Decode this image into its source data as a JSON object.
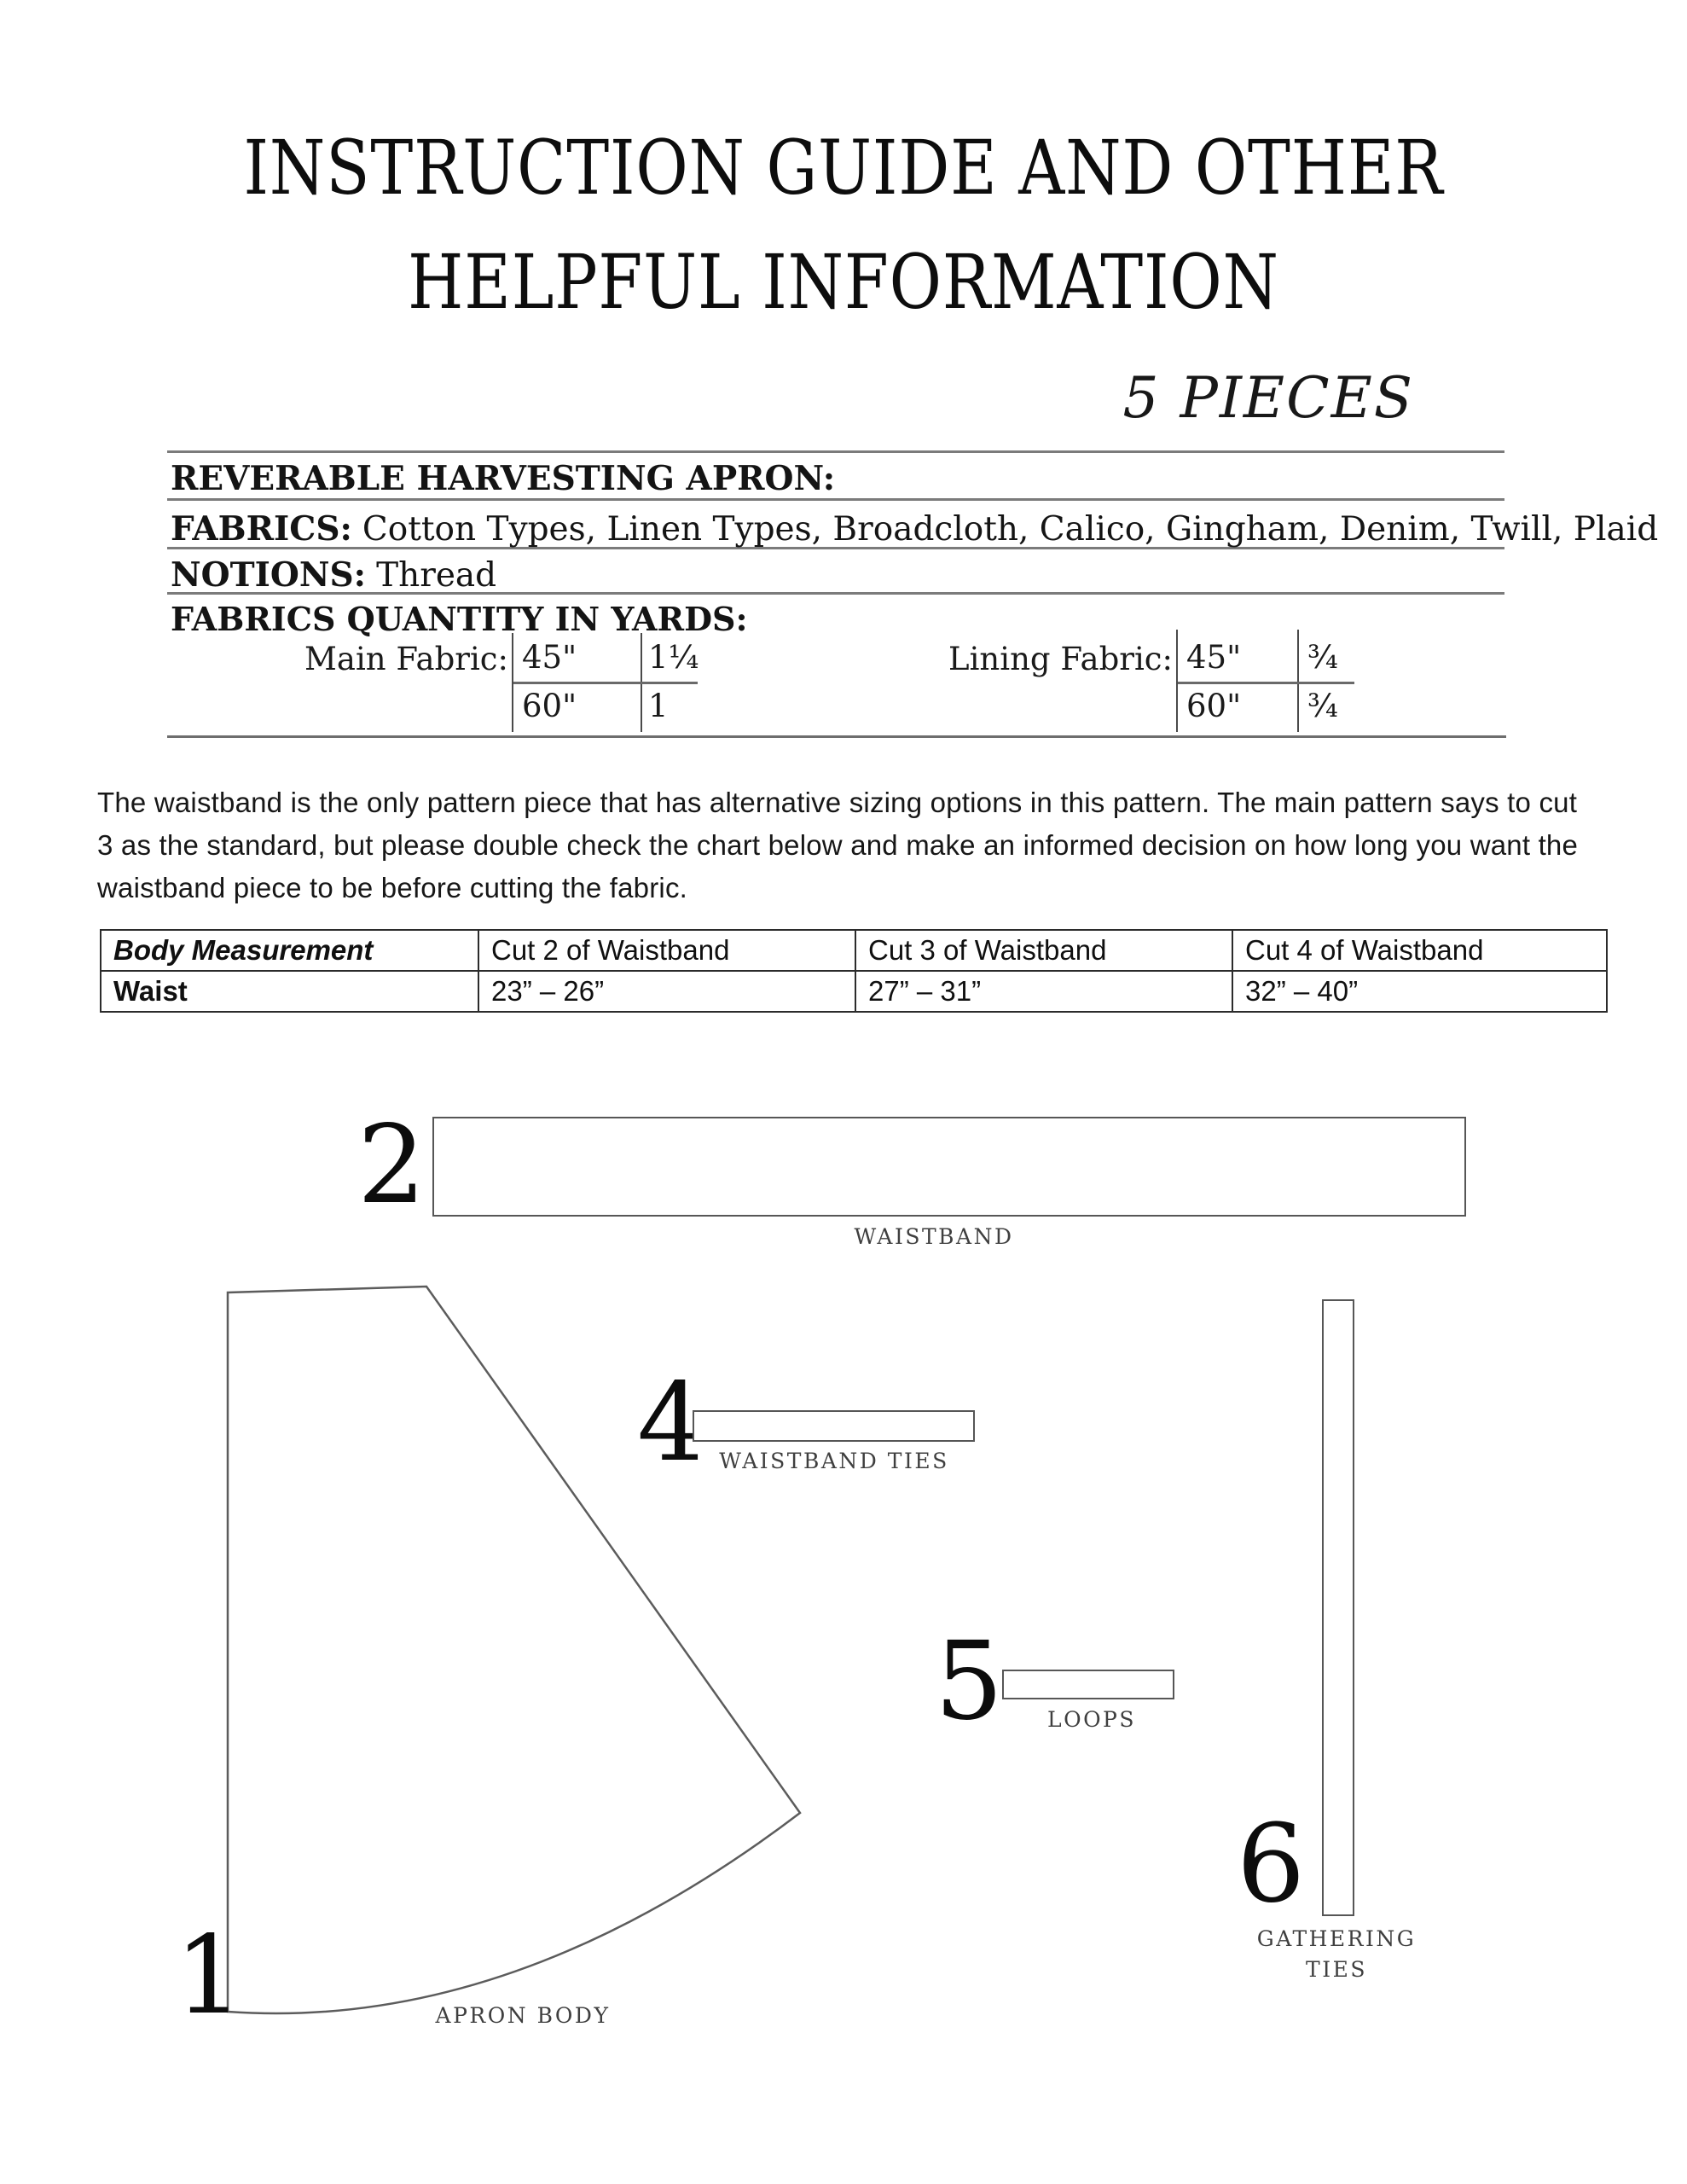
{
  "title": {
    "line1": "INSTRUCTION GUIDE AND OTHER",
    "line2": "HELPFUL INFORMATION"
  },
  "pieces_note": "5 PIECES",
  "info": {
    "name": "REVERABLE HARVESTING APRON:",
    "fabrics_label": "FABRICS:",
    "fabrics_value": "Cotton Types, Linen Types, Broadcloth, Calico, Gingham, Denim, Twill, Plaid",
    "notions_label": "NOTIONS:",
    "notions_value": "Thread",
    "quantity_heading": "FABRICS QUANTITY IN YARDS:",
    "main_fabric": {
      "label": "Main Fabric:",
      "rows": [
        {
          "width": "45\"",
          "yards": "1¼"
        },
        {
          "width": "60\"",
          "yards": "1"
        }
      ]
    },
    "lining_fabric": {
      "label": "Lining Fabric:",
      "rows": [
        {
          "width": "45\"",
          "yards": "¾"
        },
        {
          "width": "60\"",
          "yards": "¾"
        }
      ]
    }
  },
  "note": "The waistband is the only pattern piece that has alternative sizing options in this pattern. The main pattern says to cut 3 as the standard, but please double check the chart below and make an informed decision on how long you want the waistband piece to be before cutting the fabric.",
  "sizing_table": {
    "headers": [
      "Body Measurement",
      "Cut 2 of Waistband",
      "Cut 3 of Waistband",
      "Cut 4 of Waistband"
    ],
    "row_label": "Waist",
    "values": [
      "23” – 26”",
      "27” – 31”",
      "32” – 40”"
    ]
  },
  "pieces": {
    "waistband": {
      "number": "2",
      "label": "WAISTBAND"
    },
    "waistband_ties": {
      "number": "4",
      "label": "WAISTBAND TIES"
    },
    "loops": {
      "number": "5",
      "label": "LOOPS"
    },
    "gathering_ties": {
      "number": "6",
      "label": "GATHERING TIES"
    },
    "apron_body": {
      "number": "1",
      "label": "APRON BODY"
    }
  }
}
